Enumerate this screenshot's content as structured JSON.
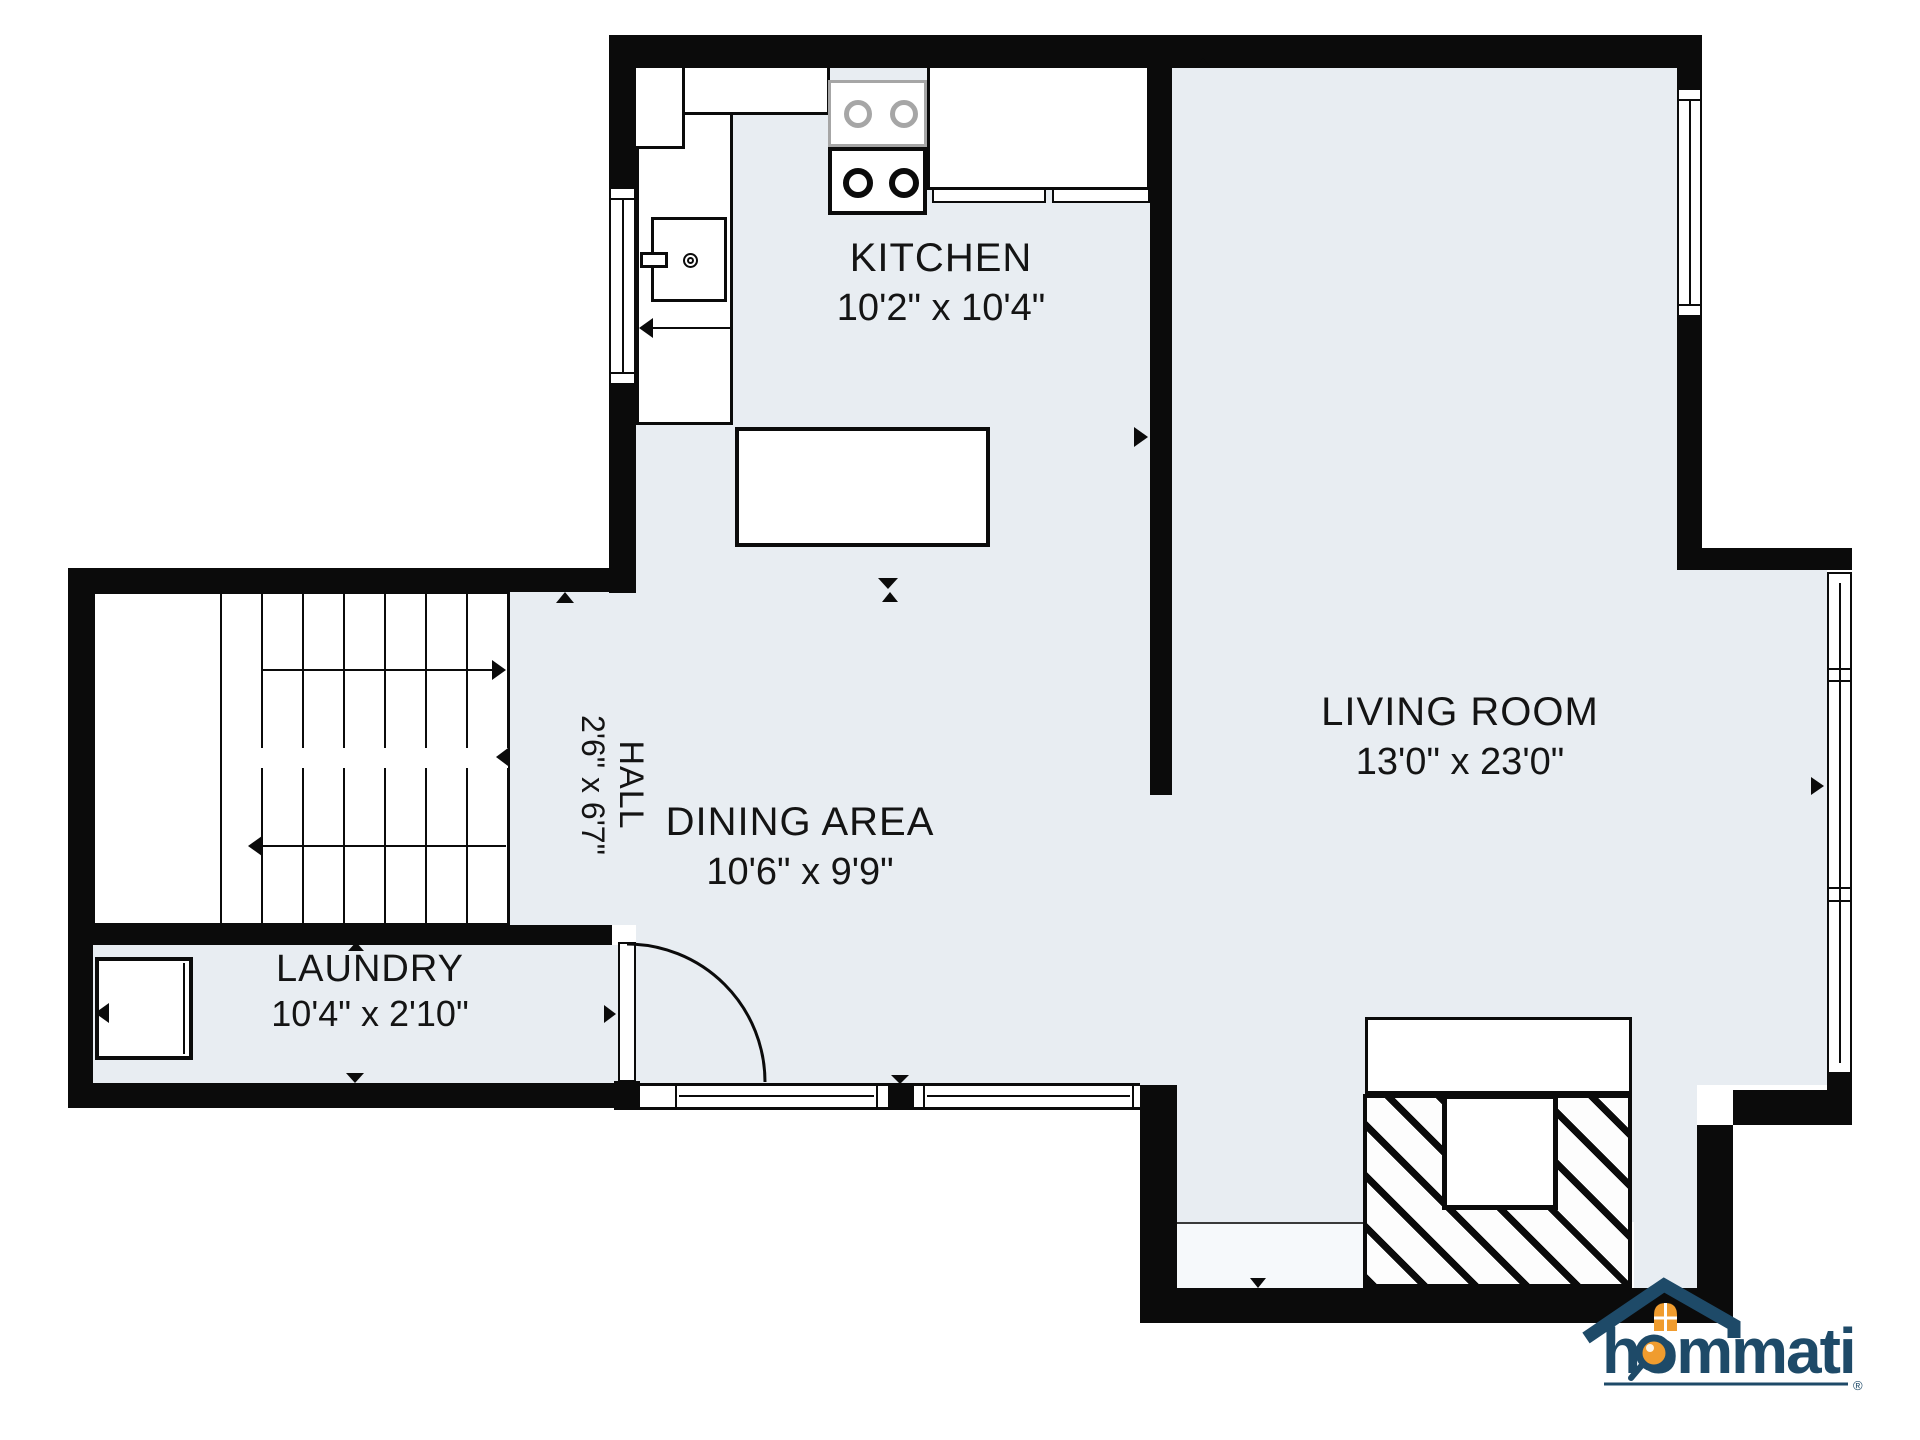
{
  "floorplan": {
    "rooms": {
      "kitchen": {
        "name": "KITCHEN",
        "dims": "10'2\" x 10'4\""
      },
      "living": {
        "name": "LIVING ROOM",
        "dims": "13'0\" x 23'0\""
      },
      "dining": {
        "name": "DINING AREA",
        "dims": "10'6\" x 9'9\""
      },
      "hall": {
        "name": "HALL",
        "dims": "2'6\" x 6'7\""
      },
      "laundry": {
        "name": "LAUNDRY",
        "dims": "10'4\" x 2'10\""
      }
    },
    "colors": {
      "floor": "#e8edf2",
      "patio": "#f6f9fb",
      "wall": "#0b0b0b",
      "logo_navy": "#1e4a68",
      "logo_orange": "#f09c2e"
    }
  },
  "logo": {
    "brand": "hommati",
    "registered": "®"
  }
}
